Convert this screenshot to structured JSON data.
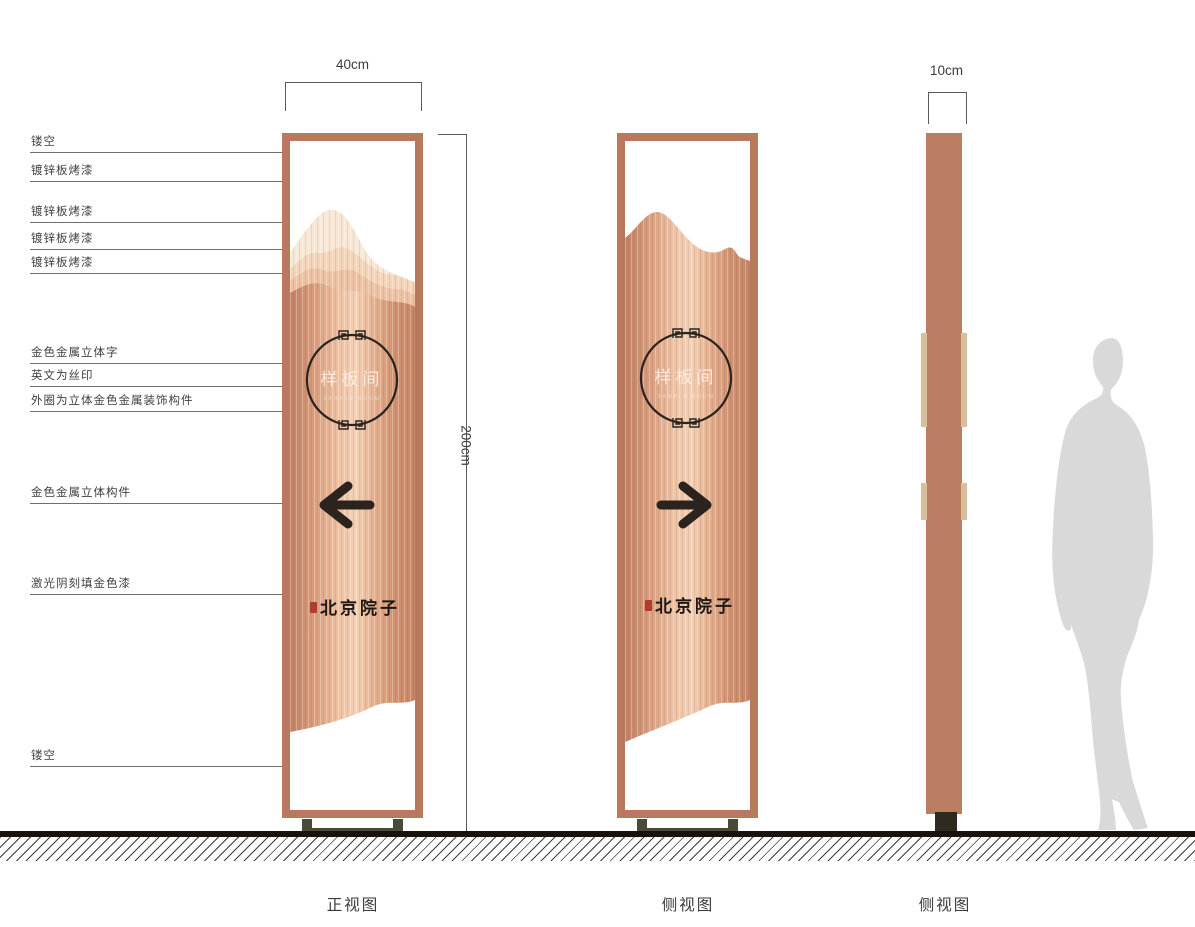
{
  "annotations": [
    {
      "text": "镂空"
    },
    {
      "text": "镀锌板烤漆"
    },
    {
      "text": "镀锌板烤漆"
    },
    {
      "text": "镀锌板烤漆"
    },
    {
      "text": "镀锌板烤漆"
    },
    {
      "text": "金色金属立体字"
    },
    {
      "text": "英文为丝印"
    },
    {
      "text": "外圈为立体金色金属装饰构件"
    },
    {
      "text": "金色金属立体构件"
    },
    {
      "text": "激光阴刻填金色漆"
    },
    {
      "text": "镂空"
    }
  ],
  "dimensions": {
    "front_width": "40cm",
    "height": "200cm",
    "side_depth": "10cm"
  },
  "views": [
    {
      "label": "正视图"
    },
    {
      "label": "侧视图"
    },
    {
      "label": "侧视图"
    }
  ],
  "sign": {
    "plate_text": "样板间",
    "plate_subtext": "SAMPLE ROOM",
    "brand_text": "北京院子"
  },
  "colors": {
    "frame_copper": "#b8795e",
    "panel_center": "#f3d0b5",
    "panel_edge": "#bf7f62",
    "mountain_layer1": "#f7e7d6",
    "mountain_layer2": "#f2d5ba",
    "mountain_layer3": "#ebc2a3",
    "ink_dark": "#2b241e",
    "seal_red": "#b23b2b",
    "side_tab": "#d7be9d",
    "stand_base": "#4d4939",
    "person_silhouette": "#d9d9d9"
  }
}
